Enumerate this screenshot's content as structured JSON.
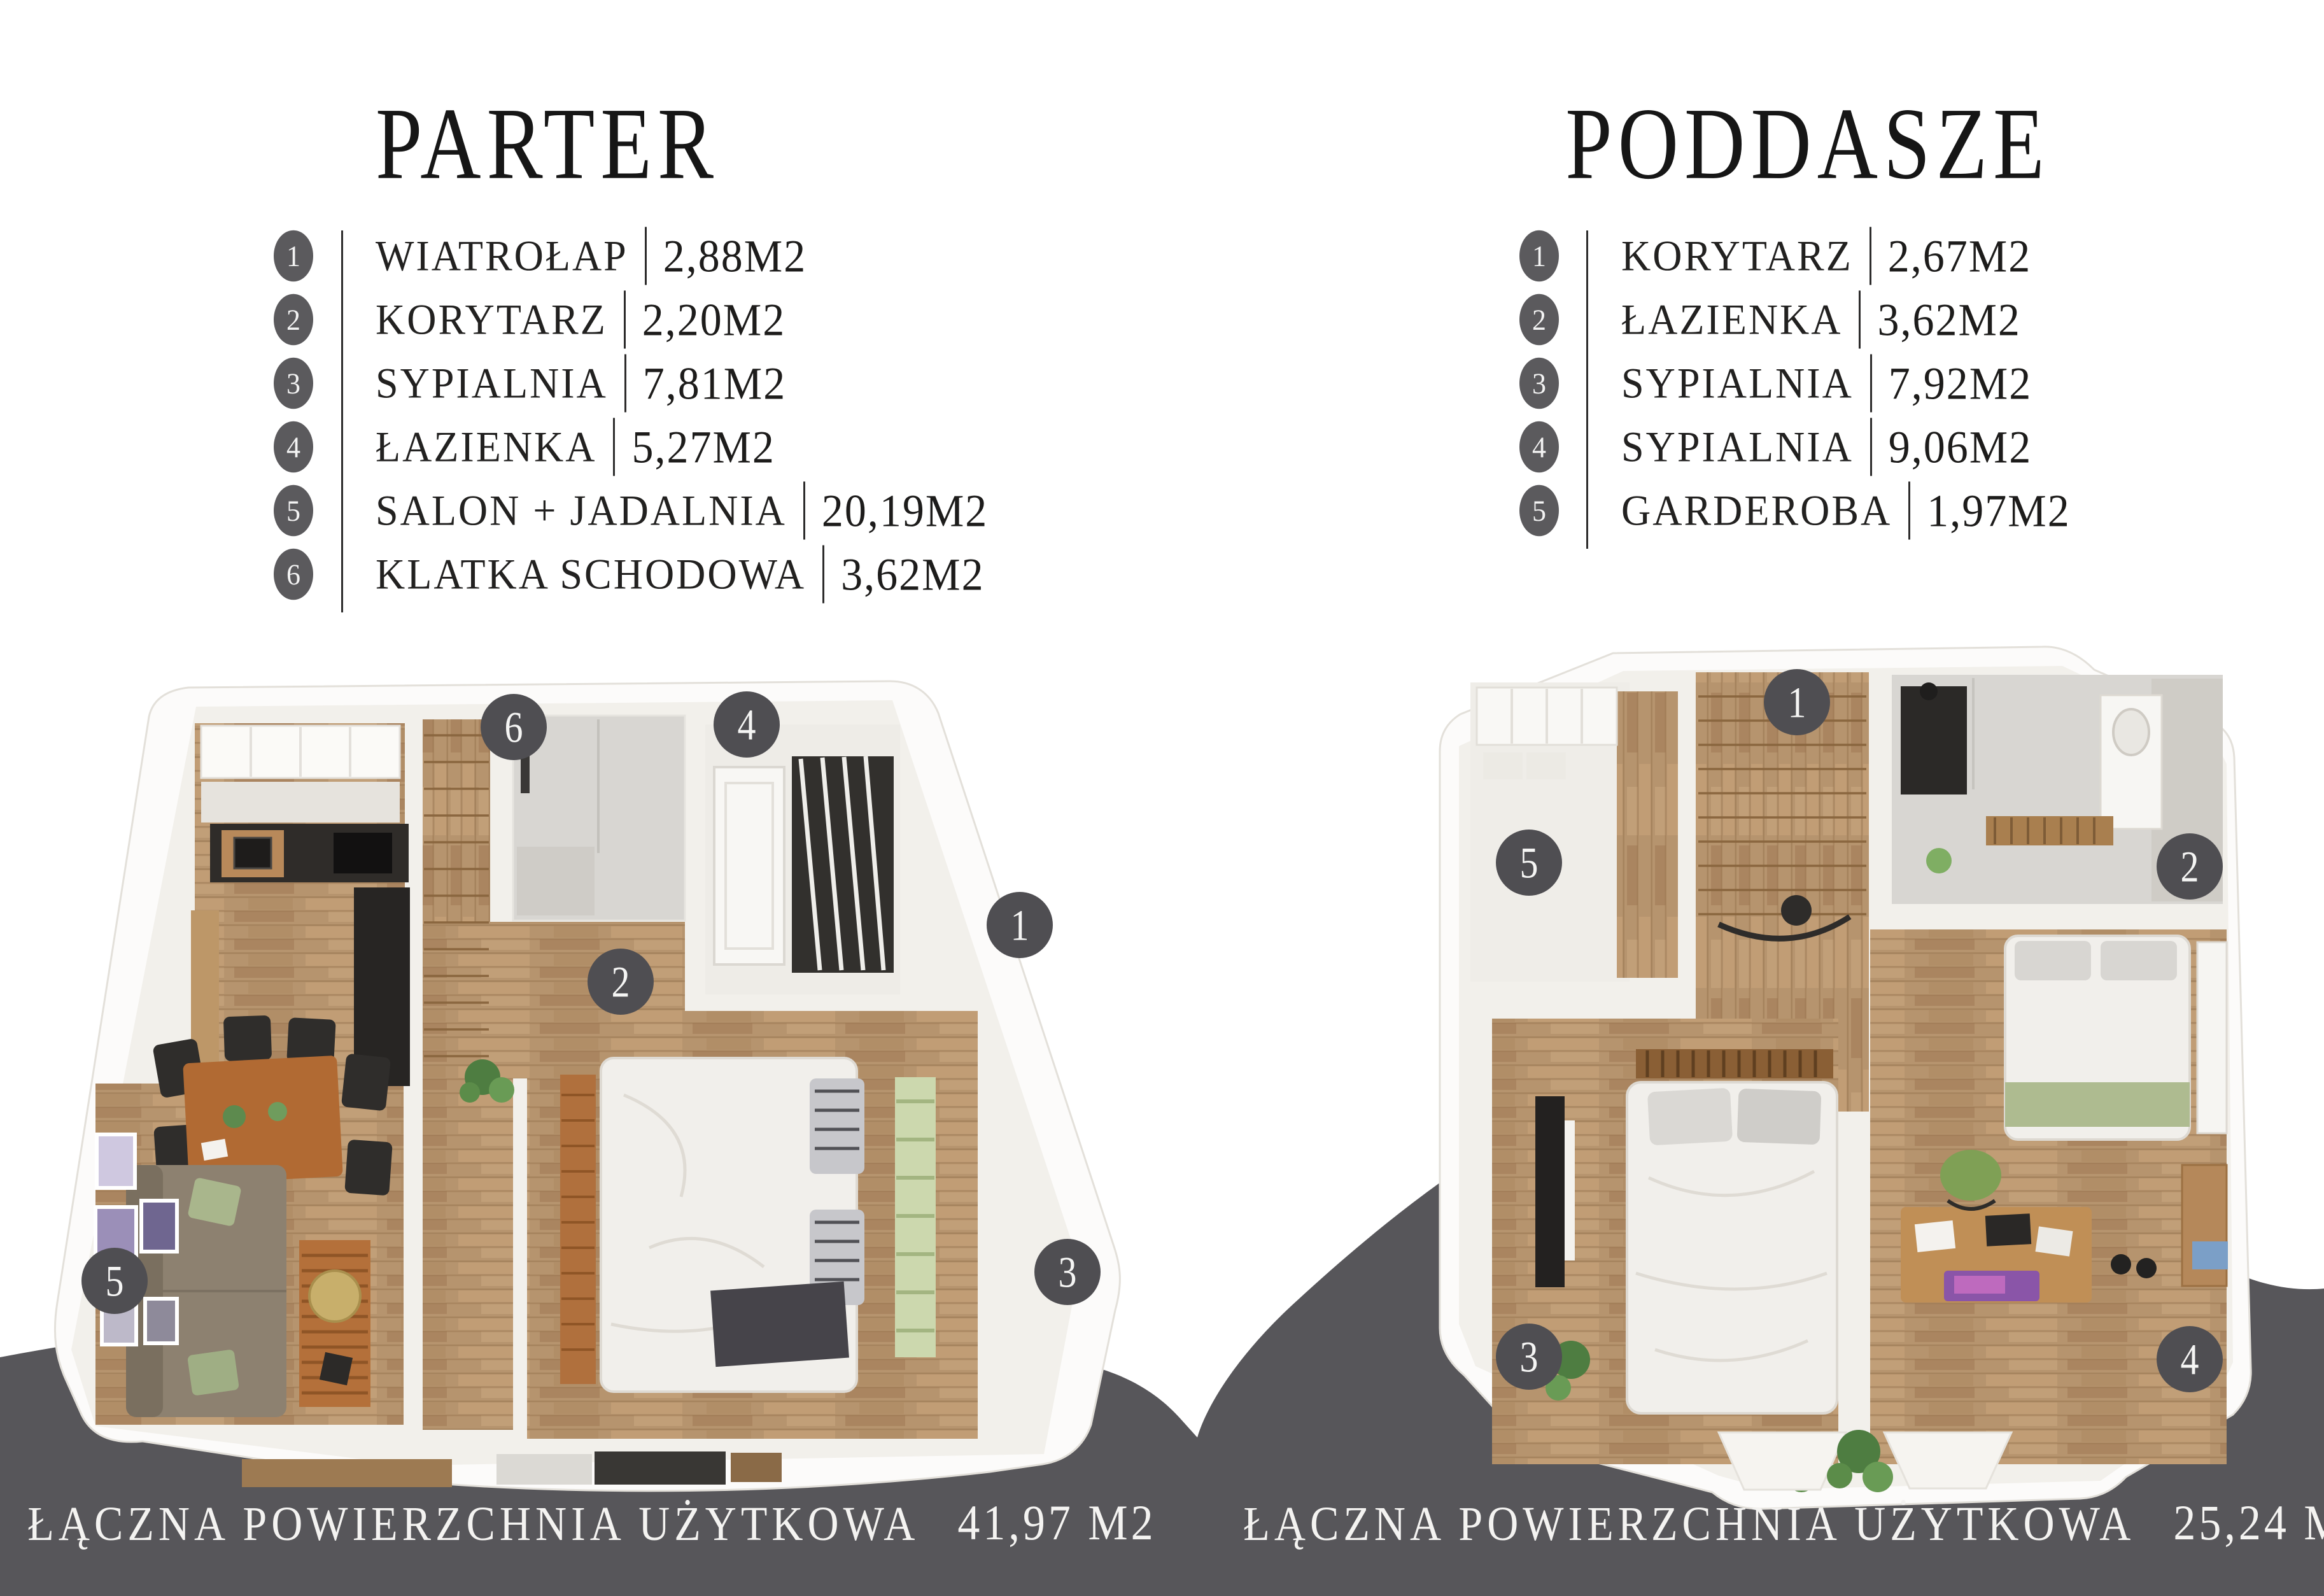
{
  "colors": {
    "band": "#57565a",
    "marker_circle": "#4f4e52",
    "legend_circle": "#5b5a5d",
    "title_text": "#161616",
    "band_text": "#f4f3f1",
    "wood_floor": "#b6946e",
    "tile_floor": "#d8d6d2"
  },
  "sections": {
    "parter": {
      "title": "PARTER",
      "rooms": [
        {
          "num": "1",
          "name": "WIATROŁAP",
          "area": "2,88M2"
        },
        {
          "num": "2",
          "name": "KORYTARZ",
          "area": "2,20M2"
        },
        {
          "num": "3",
          "name": "SYPIALNIA",
          "area": "7,81M2"
        },
        {
          "num": "4",
          "name": "ŁAZIENKA",
          "area": "5,27M2"
        },
        {
          "num": "5",
          "name": "SALON + JADALNIA",
          "area": "20,19M2"
        },
        {
          "num": "6",
          "name": "KLATKA SCHODOWA",
          "area": "3,62M2"
        }
      ],
      "markers": [
        "6",
        "4",
        "1",
        "2",
        "5",
        "3"
      ],
      "total_label": "ŁĄCZNA POWIERZCHNIA UŻYTKOWA",
      "total_value": "41,97 M2"
    },
    "poddasze": {
      "title": "PODDASZE",
      "rooms": [
        {
          "num": "1",
          "name": "KORYTARZ",
          "area": "2,67M2"
        },
        {
          "num": "2",
          "name": "ŁAZIENKA",
          "area": "3,62M2"
        },
        {
          "num": "3",
          "name": "SYPIALNIA",
          "area": "7,92M2"
        },
        {
          "num": "4",
          "name": "SYPIALNIA",
          "area": "9,06M2"
        },
        {
          "num": "5",
          "name": "GARDEROBA",
          "area": "1,97M2"
        }
      ],
      "markers": [
        "1",
        "5",
        "2",
        "3",
        "4"
      ],
      "total_label": "ŁĄCZNA POWIERZCHNIA UŻYTKOWA",
      "total_value": "25,24 M2"
    }
  }
}
